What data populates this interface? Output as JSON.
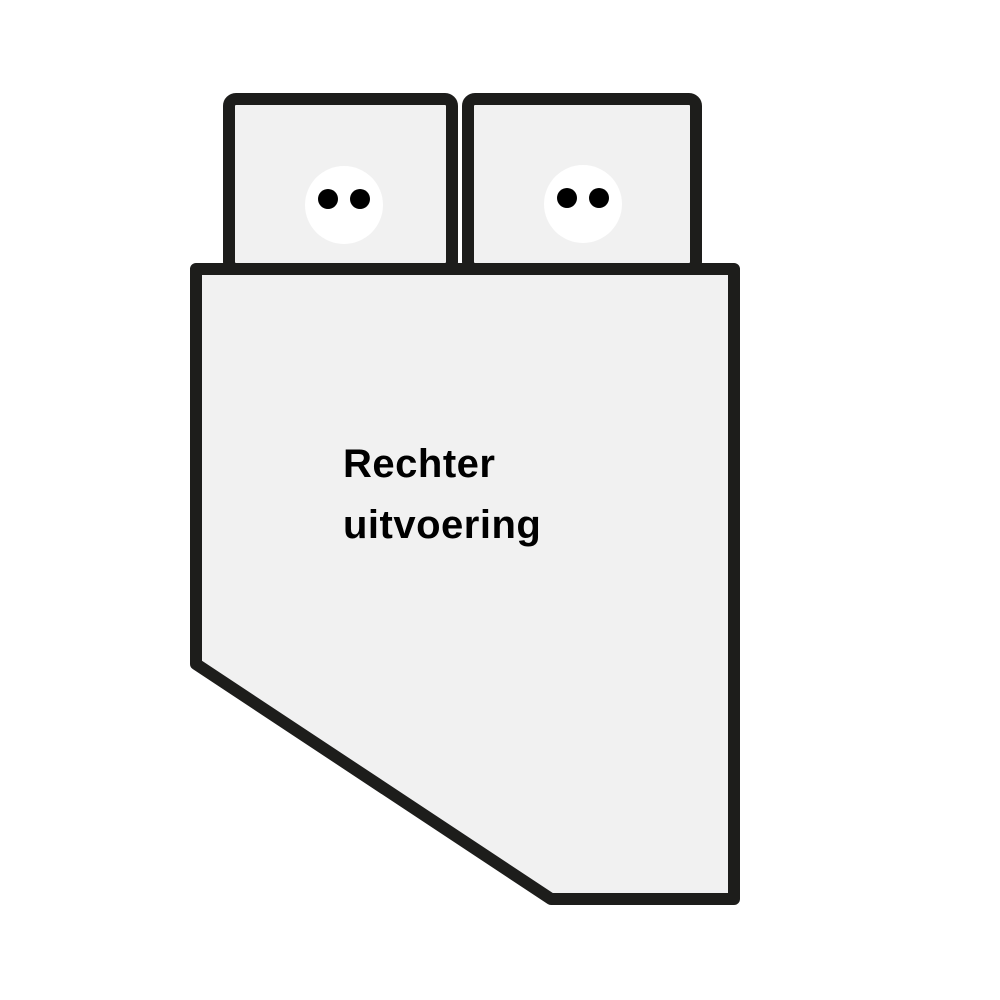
{
  "diagram": {
    "label": "Rechter uitvoering",
    "title_lines": [
      "Rechter",
      "uitvoering"
    ],
    "pillow_count": 2,
    "button_holes_per_pillow": 2,
    "colors": {
      "background": "#ffffff",
      "surface": "#f1f1f1",
      "outline": "#1d1d1b",
      "button": "#ffffff",
      "button_hole": "#000000",
      "text": "#000000"
    }
  }
}
